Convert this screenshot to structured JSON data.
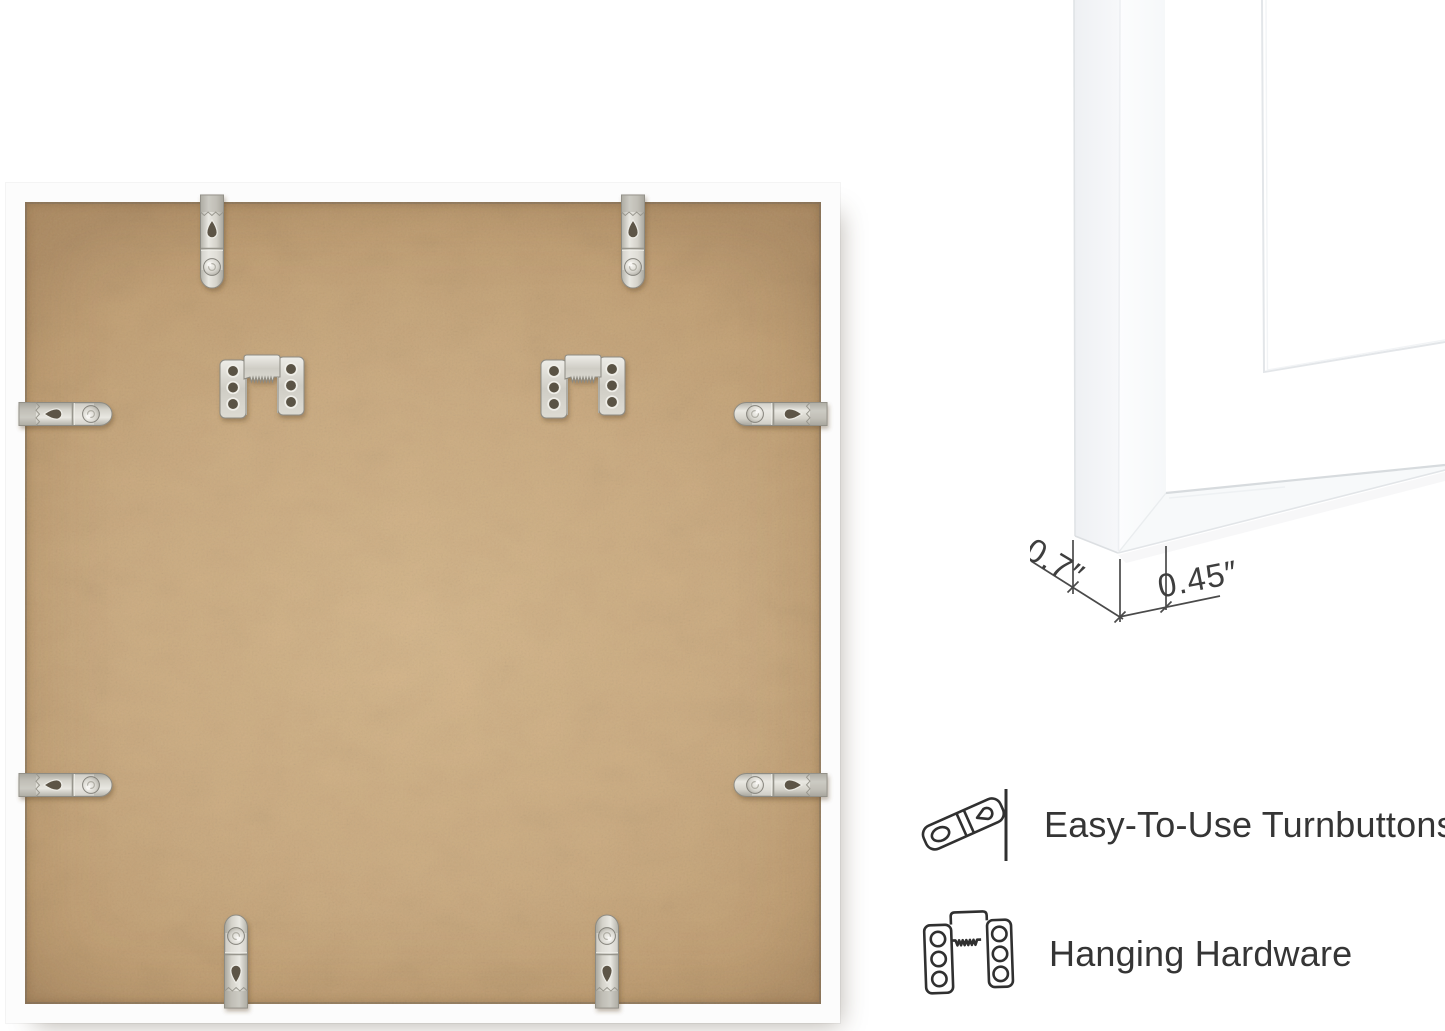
{
  "corner_diagram": {
    "depth_label": "0.7″",
    "face_label": "0.45″"
  },
  "features": {
    "items": [
      {
        "icon": "turnbutton-icon",
        "label": "Easy-To-Use Turnbuttons"
      },
      {
        "icon": "hanging-hardware-icon",
        "label": "Hanging Hardware"
      }
    ]
  },
  "colors": {
    "background": "#ffffff",
    "frame_white": "#fcfcfc",
    "mdf_base": "#cdad82",
    "metal": "#d6d4cc",
    "line_art": "#303030",
    "dimension_line": "#4a4a4a",
    "label_text": "#353535"
  }
}
